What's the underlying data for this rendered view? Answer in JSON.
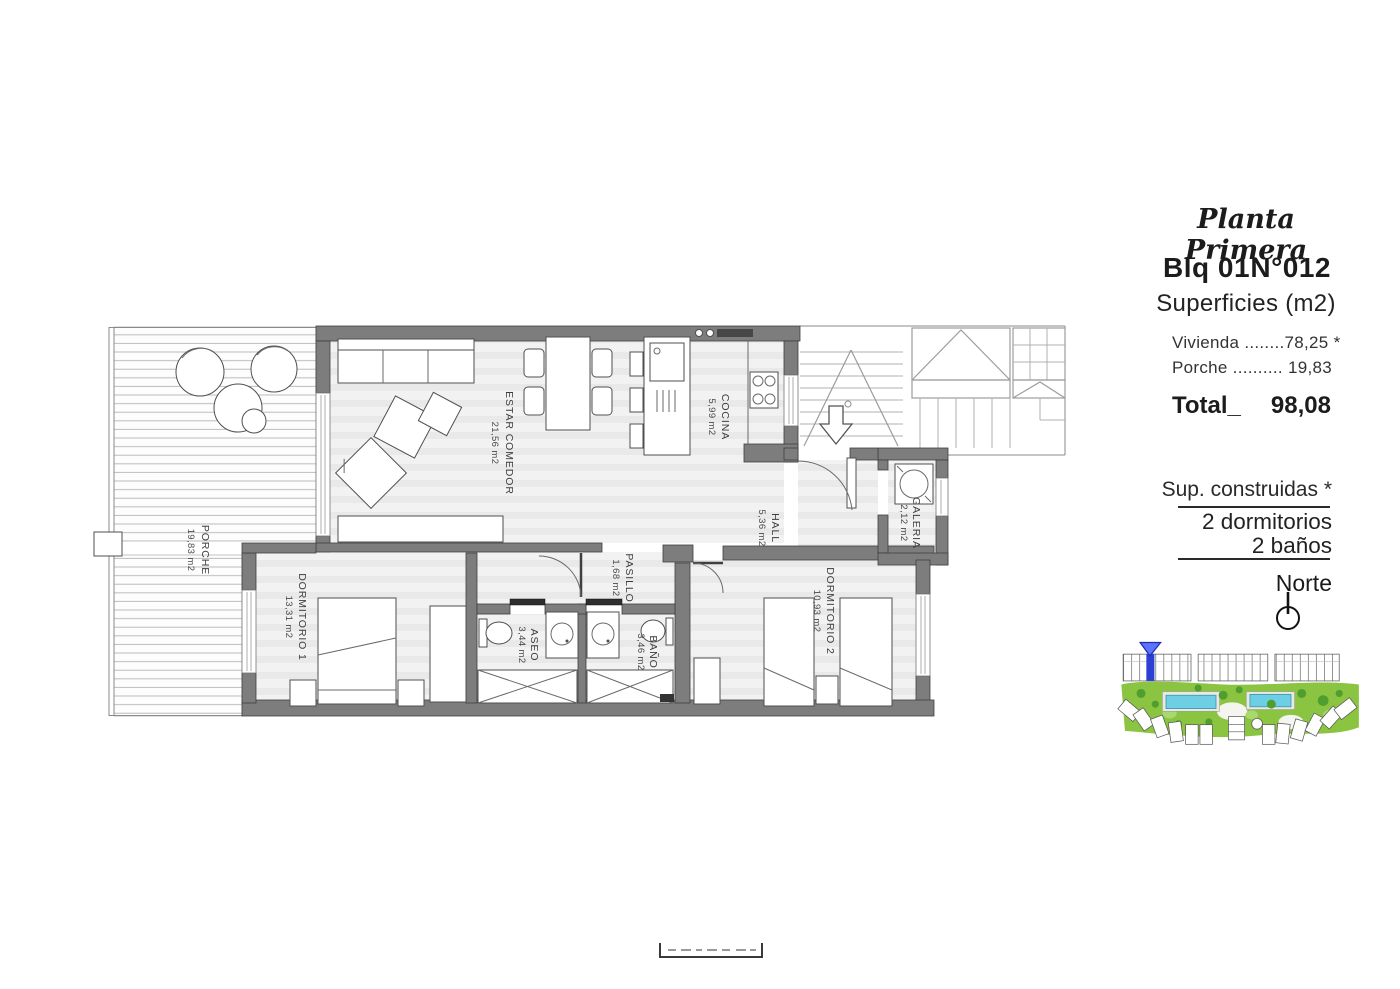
{
  "header": {
    "plan_title": "Planta Primera",
    "block": "Blq 01",
    "unit": "N°012",
    "surfaces_heading": "Superficies (m2)"
  },
  "surfaces": {
    "vivienda_row": "Vivienda ........78,25 *",
    "porche_row": "Porche .......... 19,83",
    "total_label": "Total_",
    "total_value": "98,08"
  },
  "summary": {
    "built_note": "Sup. construidas *",
    "bedrooms": "2 dormitorios",
    "bathrooms": "2 baños",
    "north_label": "Norte"
  },
  "rooms": {
    "porche": {
      "name": "PORCHE",
      "area": "19,83 m2"
    },
    "estar": {
      "name": "ESTAR COMEDOR",
      "area": "21,56 m2"
    },
    "cocina": {
      "name": "COCINA",
      "area": "5,99 m2"
    },
    "hall": {
      "name": "HALL",
      "area": "5,36 m2"
    },
    "galeria": {
      "name": "GALERIA",
      "area": "2,12 m2"
    },
    "pasillo": {
      "name": "PASILLO",
      "area": "1,68 m2"
    },
    "dorm1": {
      "name": "DORMITORIO 1",
      "area": "13,31 m2"
    },
    "aseo": {
      "name": "ASEO",
      "area": "3,44 m2"
    },
    "bano": {
      "name": "BAÑO",
      "area": "3,46 m2"
    },
    "dorm2": {
      "name": "DORMITORIO 2",
      "area": "10,93 m2"
    }
  },
  "icons": {
    "north_compass": "circle-with-needle",
    "stair_direction": "down-arrow",
    "site_plan_marker": "blue-location-triangle"
  },
  "colors": {
    "wall_fill": "#7d7d7d",
    "marker_blue": "#2e3fd4",
    "lawn_green": "#8ac441",
    "pool_blue": "#6ecfe4"
  }
}
